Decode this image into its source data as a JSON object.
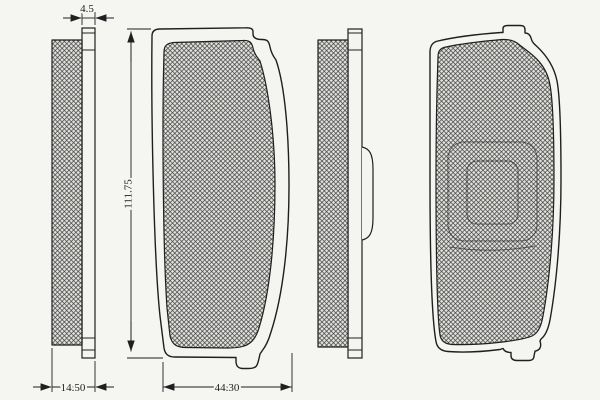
{
  "dimensions": {
    "plate_thickness": "4.5",
    "total_thickness": "14.50",
    "pad_width": "44.30",
    "pad_length": "111.75"
  },
  "colors": {
    "line": "#1f1f1f",
    "background": "#f5f5f2",
    "hatch_line": "#3b3b3b",
    "hatch_bg": "#e2e2df",
    "plate_fill": "#f4f4f1"
  }
}
